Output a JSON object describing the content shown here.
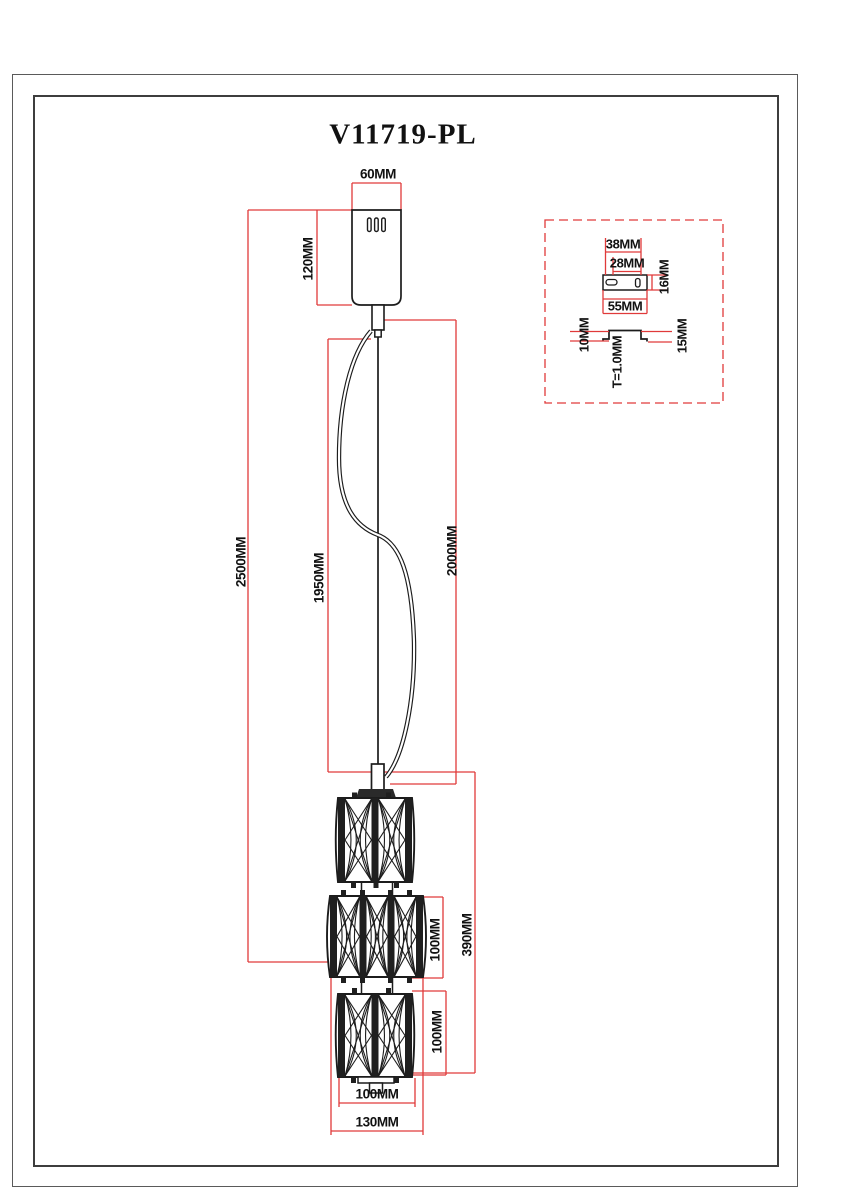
{
  "drawing": {
    "model": "V11719-PL",
    "colors": {
      "dimension_lines": "#e03a3a",
      "drawing_lines": "#1c1c1c",
      "background": "#ffffff"
    },
    "dim": {
      "canopy_width": "60MM",
      "canopy_height": "120MM",
      "total_drop": "2500MM",
      "cable_length": "1950MM",
      "wire_length": "2000MM",
      "shade_stack_height": "390MM",
      "shade2_height": "100MM",
      "shade3_height": "100MM",
      "shade_width": "100MM",
      "max_width": "130MM"
    },
    "inset": {
      "slot_span": "38MM",
      "slot_inner_span": "28MM",
      "plate_depth": "16MM",
      "plate_width": "55MM",
      "left_step": "10MM",
      "right_step": "15MM",
      "thickness": "T=1.0MM"
    }
  }
}
